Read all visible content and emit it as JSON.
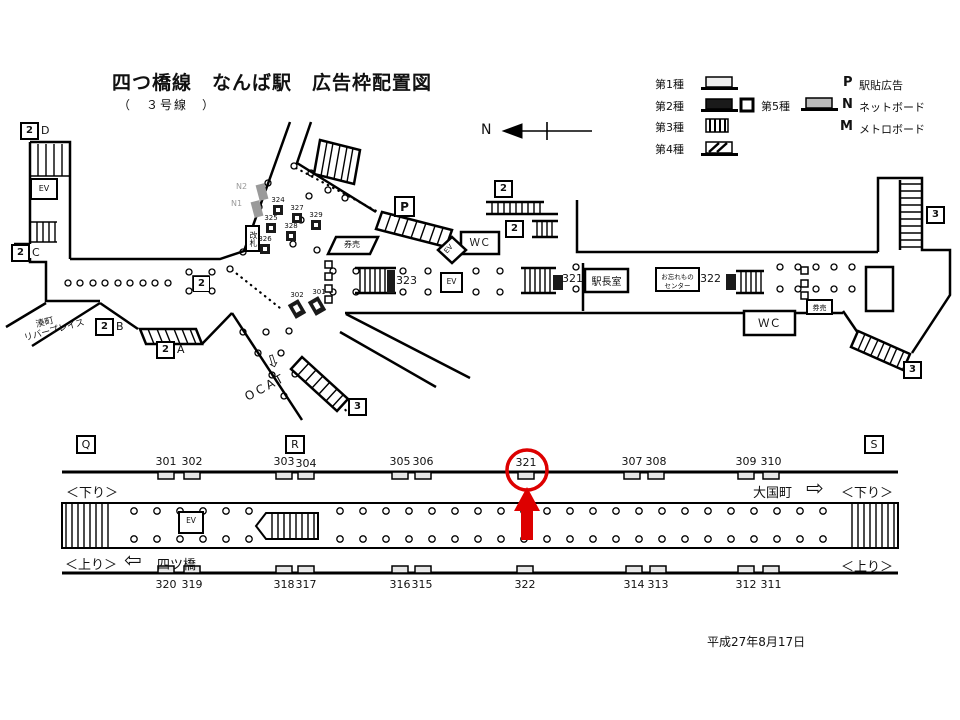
{
  "header": {
    "title": "四つ橋線　なんば駅　広告枠配置図",
    "subtitle": "（　３号線　）"
  },
  "footer": {
    "date": "平成27年8月17日"
  },
  "compass": {
    "north": "N"
  },
  "legend": {
    "type1": "第1種",
    "type2": "第2種",
    "type3": "第3種",
    "type4": "第4種",
    "type5": "第5種",
    "p_symbol": "P",
    "p_label": "駅貼広告",
    "n_symbol": "N",
    "n_label": "ネットボード",
    "m_symbol": "M",
    "m_label": "メトロボード"
  },
  "map": {
    "exits": {
      "d": {
        "number": "2",
        "letter": "D"
      },
      "c": {
        "number": "2",
        "letter": "C"
      },
      "b": {
        "number": "2",
        "letter": "B"
      },
      "a": {
        "number": "2",
        "letter": "A"
      },
      "concourse": {
        "number": "2"
      },
      "north_upper": {
        "number": "2"
      },
      "north_lower": {
        "number": "2"
      },
      "east_top": {
        "number": "3"
      },
      "east_bottom": {
        "number": "3"
      },
      "south": {
        "number": "3"
      }
    },
    "labels": {
      "ev_left": "EV",
      "ev_diamond": "EV",
      "ev_center": "EV",
      "wc_top": "ＷＣ",
      "wc_right": "ＷＣ",
      "kiosk_center": "券売",
      "kiosk_right": "券売",
      "ticket_gate": "改札",
      "p_box": "P",
      "station_master": "駅長室",
      "lost_found_line1": "お忘れもの",
      "lost_found_line2": "センター",
      "ocat": "OCAT",
      "ocat_arrow": "⇩",
      "minatomachi_line1": "湊町",
      "minatomachi_line2": "リバープレイス"
    },
    "netboards": {
      "n2": "N2",
      "n1": "N1"
    },
    "ad_positions": {
      "a324": "324",
      "a327": "327",
      "a329": "329",
      "a325": "325",
      "a328": "328",
      "a326": "326",
      "a302": "302",
      "a301": "301",
      "a323": "323",
      "a321": "321",
      "a322": "322"
    }
  },
  "platform": {
    "sections": {
      "q": "Q",
      "r": "R",
      "s": "S"
    },
    "upper_row": [
      "301",
      "302",
      "303",
      "304",
      "305",
      "306",
      "321",
      "307",
      "308",
      "309",
      "310"
    ],
    "lower_row": [
      "320",
      "319",
      "318",
      "317",
      "316",
      "315",
      "322",
      "314",
      "313",
      "312",
      "311"
    ],
    "down_left": "＜下り＞",
    "down_right": "＜下り＞",
    "up_left": "＜上り＞",
    "up_right": "＜上り＞",
    "left_station": "四ツ橋",
    "left_arrow": "⇦",
    "right_station": "大国町",
    "right_arrow": "⇨",
    "ev": "EV",
    "highlighted_position": "321"
  },
  "colors": {
    "accent_red": "#dd0000",
    "netboard_gray": "#9a9a9a",
    "type5_gray": "#bbbbbb"
  }
}
